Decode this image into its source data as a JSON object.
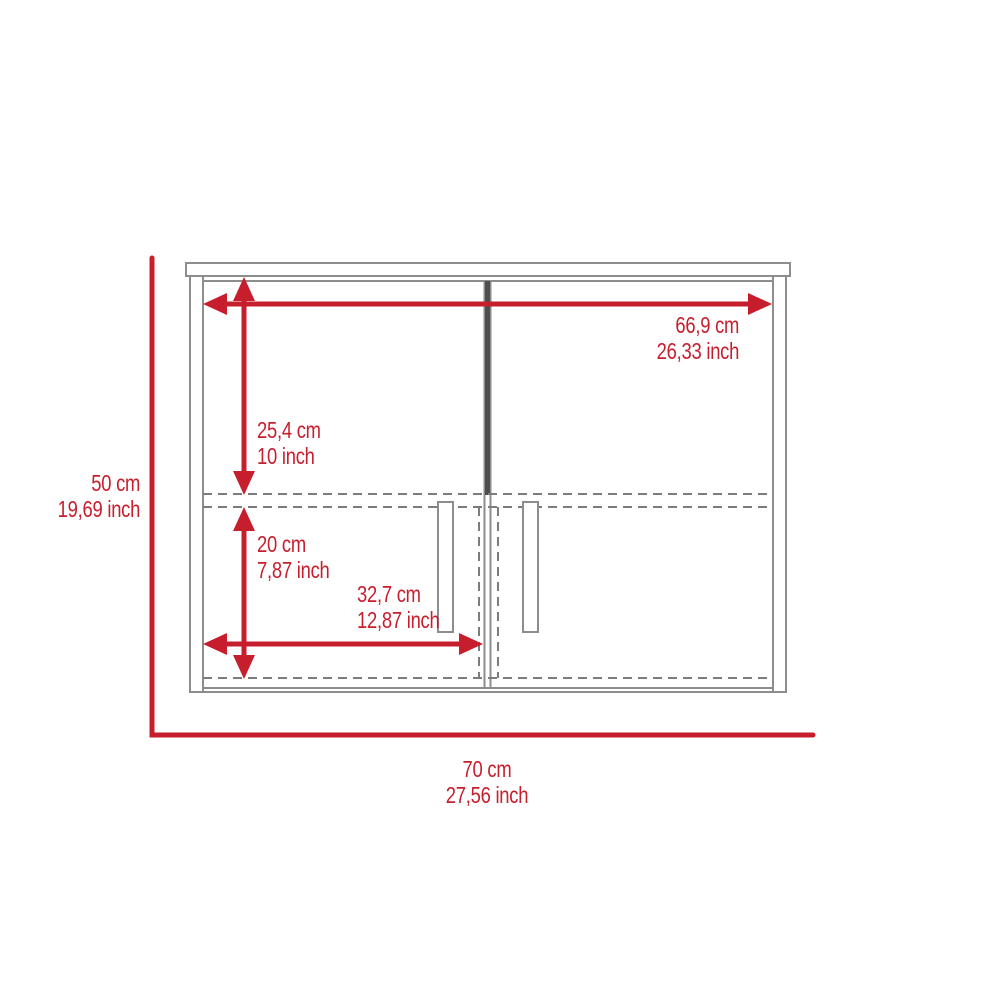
{
  "diagram": {
    "name": "cabinet-dimension-diagram",
    "description": "Front-view dimension drawing of a two-door wall cabinet with shelf (dashed) lines and vertical door handles",
    "dimensions": {
      "overall_width": {
        "cm": "70 cm",
        "inch": "27,56 inch"
      },
      "overall_height": {
        "cm": "50 cm",
        "inch": "19,69 inch"
      },
      "door_span_width": {
        "cm": "66,9 cm",
        "inch": "26,33 inch"
      },
      "upper_section_height": {
        "cm": "25,4 cm",
        "inch": "10 inch"
      },
      "lower_section_height": {
        "cm": "20 cm",
        "inch": "7,87 inch"
      },
      "single_door_width": {
        "cm": "32,7 cm",
        "inch": "12,87 inch"
      }
    }
  },
  "colors": {
    "dimension_red": "#c71e2d",
    "outline_gray": "#8d8d8d",
    "dashed_gray": "#7c7c7c",
    "divider_dark": "#4e4e4e",
    "background": "#ffffff"
  }
}
